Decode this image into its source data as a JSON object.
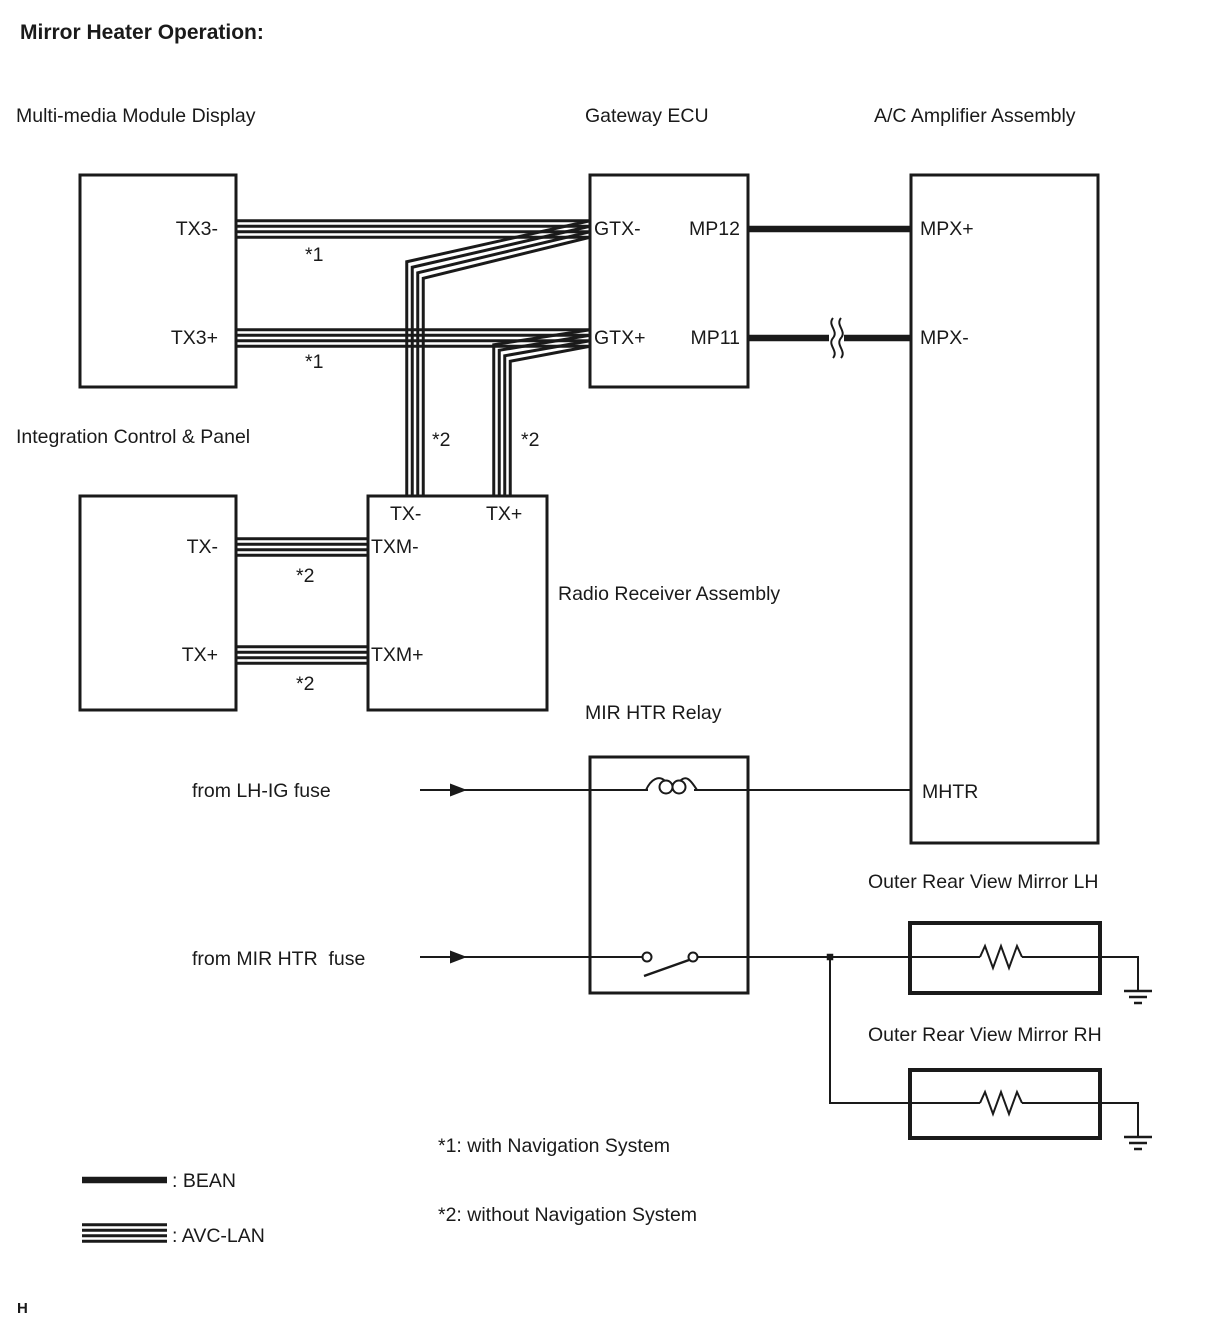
{
  "page": {
    "title": "Mirror Heater Operation:",
    "footer_mark": "H",
    "colors": {
      "ink": "#1a1a1a",
      "background": "#ffffff"
    }
  },
  "components": {
    "multimedia": {
      "label": "Multi-media Module Display",
      "pin_tx3_minus": "TX3-",
      "pin_tx3_plus": "TX3+"
    },
    "gateway": {
      "label": "Gateway ECU",
      "pin_gtx_minus": "GTX-",
      "pin_gtx_plus": "GTX+",
      "pin_mp12": "MP12",
      "pin_mp11": "MP11"
    },
    "ac_amplifier": {
      "label": "A/C Amplifier Assembly",
      "pin_mpx_plus": "MPX+",
      "pin_mpx_minus": "MPX-",
      "pin_mhtr": "MHTR"
    },
    "integration_panel": {
      "label": "Integration Control & Panel",
      "pin_tx_minus": "TX-",
      "pin_tx_plus": "TX+"
    },
    "radio_receiver": {
      "label": "Radio Receiver Assembly",
      "pin_tx_minus": "TX-",
      "pin_tx_plus": "TX+",
      "pin_txm_minus": "TXM-",
      "pin_txm_plus": "TXM+"
    },
    "mir_htr_relay": {
      "label": "MIR HTR Relay"
    },
    "mirror_lh": {
      "label": "Outer Rear View Mirror LH"
    },
    "mirror_rh": {
      "label": "Outer Rear View Mirror RH"
    }
  },
  "sources": {
    "lh_ig_fuse": "from LH-IG fuse",
    "mir_htr_fuse": "from MIR HTR  fuse"
  },
  "wire_tags": {
    "with_nav": "*1",
    "without_nav": "*2"
  },
  "notes": {
    "note_1": "*1: with Navigation System",
    "note_2": "*2: without Navigation System"
  },
  "legend": [
    {
      "symbol": "bean-line",
      "label": ": BEAN"
    },
    {
      "symbol": "avc-lan-lines",
      "label": ": AVC-LAN"
    }
  ]
}
